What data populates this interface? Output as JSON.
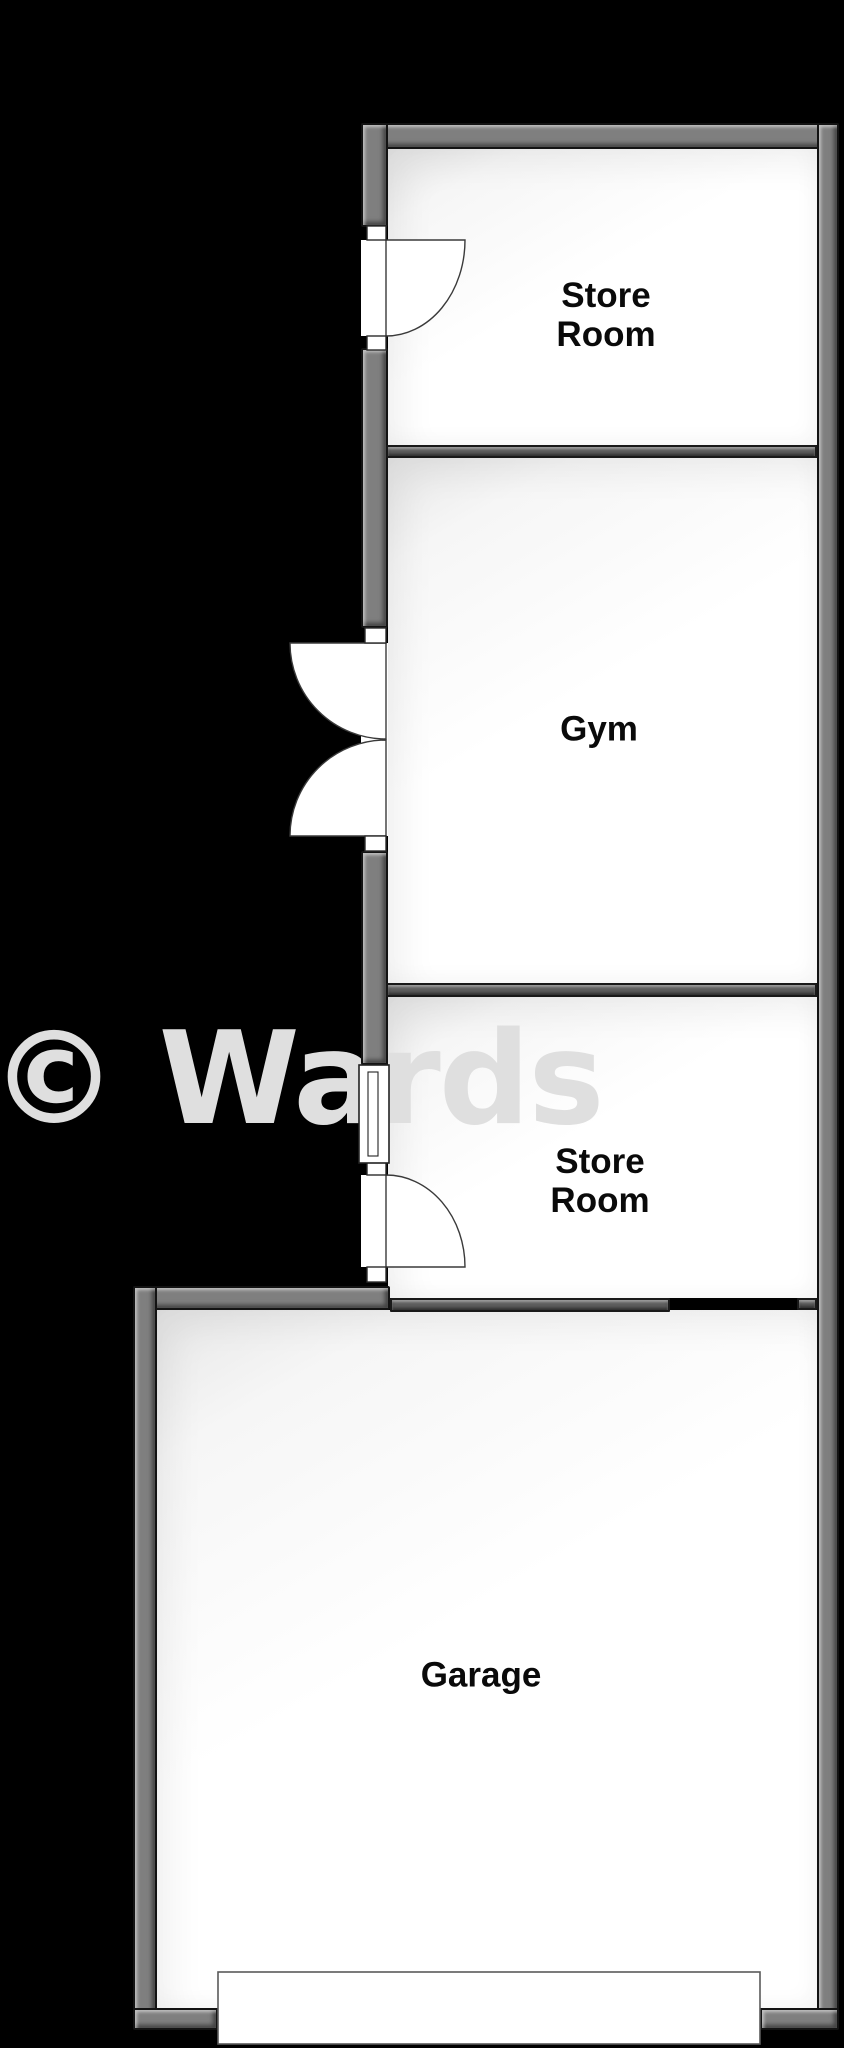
{
  "floorplan": {
    "background_color": "#000000",
    "wall_color": "#7f7f7f",
    "inner_wall_color": "#5e5e5e",
    "room_fill_color": "#ffffff",
    "label_color": "#0a0a0a",
    "rooms": [
      {
        "id": "store-room-1",
        "label": "Store\nRoom"
      },
      {
        "id": "gym",
        "label": "Gym"
      },
      {
        "id": "store-room-2",
        "label": "Store\nRoom"
      },
      {
        "id": "garage",
        "label": "Garage"
      }
    ],
    "watermark": {
      "text": "© Wards",
      "color": "#dfdfdf"
    }
  }
}
